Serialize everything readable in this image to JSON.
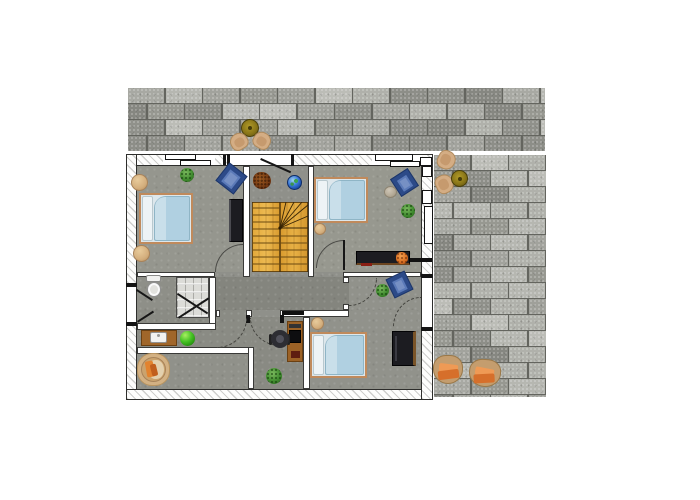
{
  "scene": {
    "type": "floor-plan",
    "view": "top-down",
    "storey": "upper-floor-with-terrace",
    "background": "#ffffff"
  },
  "palette": {
    "paving_joint": "#64655f",
    "paving_tiles": [
      "#b6b7b1",
      "#9fa09a",
      "#8d8e88",
      "#a8a9a3",
      "#979891",
      "#b0b1ab",
      "#868781",
      "#a2a39d",
      "#bcbdb7",
      "#90918b"
    ],
    "concrete_floor": "#8f908a",
    "wall_white": "#ffffff",
    "stair_wood": "#e0a43c",
    "bed_mattress": "#b0d0e1",
    "bed_frame": "#c08a5c",
    "armchair_blue": "#2c4a88",
    "accent_orange": "#e0832f",
    "plant_green": "#3f8a2e",
    "furniture_wood": "#9c6226",
    "dark_furniture": "#1c1c21"
  },
  "terrace": {
    "areas": [
      "top-strip",
      "right-block"
    ],
    "furniture": [
      "bistro-table-top",
      "terrace-chair",
      "terrace-chair",
      "bistro-table-right",
      "terrace-chair",
      "terrace-chair",
      "lounge-chair",
      "lounge-chair"
    ]
  },
  "rooms": [
    {
      "id": "bedroom-top-left",
      "furniture": [
        "double-bed",
        "pouf",
        "pouf",
        "plant",
        "blue-armchair",
        "media-panel"
      ]
    },
    {
      "id": "stair-hall",
      "furniture": [
        "u-shaped-wood-staircase",
        "dried-plant",
        "globe"
      ],
      "doors": [
        "entrance-door"
      ]
    },
    {
      "id": "bedroom-top-right",
      "furniture": [
        "double-bed",
        "blue-armchair",
        "gray-pouf",
        "plant",
        "pouf",
        "sideboard",
        "orange-plant"
      ]
    },
    {
      "id": "corridor",
      "furniture": []
    },
    {
      "id": "bathroom",
      "furniture": [
        "toilet",
        "shower"
      ]
    },
    {
      "id": "utility-strip",
      "furniture": [
        "vanity-sink",
        "green-ball"
      ]
    },
    {
      "id": "room-bottom-left",
      "furniture": [
        "round-rug",
        "orange-armchair"
      ]
    },
    {
      "id": "office-nook",
      "furniture": [
        "desk",
        "laptop",
        "office-chair",
        "plant"
      ]
    },
    {
      "id": "bedroom-bottom-right",
      "furniture": [
        "double-bed",
        "blue-armchair",
        "plant",
        "pouf",
        "wardrobe"
      ]
    }
  ]
}
